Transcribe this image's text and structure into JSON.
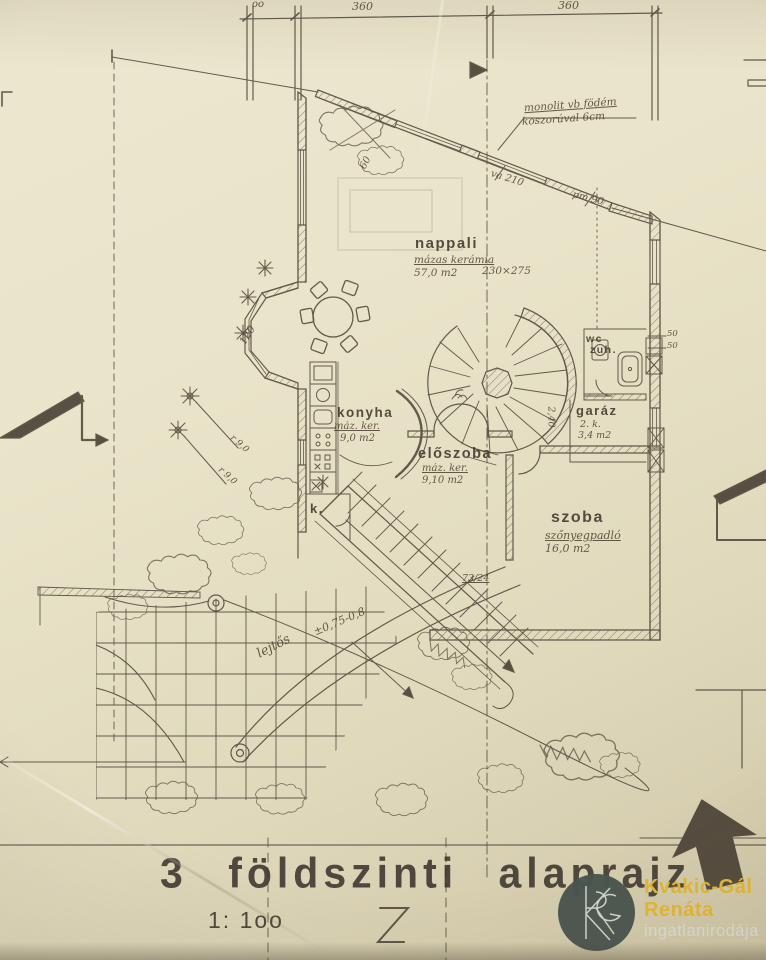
{
  "colors": {
    "paper": "#e9e3c9",
    "ink": "#463d2f",
    "watermark_circle": "#47544e",
    "watermark_accent": "#e2b733",
    "watermark_text": "#d9ddd3"
  },
  "title": {
    "label": "3 földszinti alaprajz",
    "scale": "1: 1oo"
  },
  "dimensions": {
    "top_left_partial": "oo",
    "top_span_1": "360",
    "top_span_2": "360",
    "bay_width": "120",
    "corner": "60",
    "wall_a": "va 210",
    "wall_b": "pm 90",
    "side": "2,40",
    "shaft_a": "50",
    "shaft_b": "50",
    "stair": "73/24",
    "level_a": "r 9,0",
    "level_b": "r 9,0"
  },
  "notes": {
    "roof_line1": "monolit vb födém",
    "roof_line2": "koszorúval 6cm",
    "slope": "lejtős",
    "slope_value": "±0,75-0,8"
  },
  "rooms": {
    "nappali": {
      "name": "nappali",
      "finish": "mázas kerámia",
      "area": "57,0 m2",
      "size": "230×275"
    },
    "konyha": {
      "name": "konyha",
      "finish": "máz. ker.",
      "area": "9,0 m2"
    },
    "eloszoba": {
      "name": "előszoba",
      "finish": "máz. ker.",
      "area": "9,10 m2"
    },
    "szoba": {
      "name": "szoba",
      "finish": "szőnyegpadló",
      "area": "16,0 m2"
    },
    "wc": {
      "name_line1": "wc",
      "name_line2": "zuh."
    },
    "garaz": {
      "name": "garáz",
      "note": "2. k.",
      "area": "3,4 m2"
    },
    "kamra": {
      "name": "k."
    }
  },
  "watermark": {
    "line1": "Kvakic-Gál",
    "line2": "Renáta",
    "line3": "ingatlanirodája"
  }
}
